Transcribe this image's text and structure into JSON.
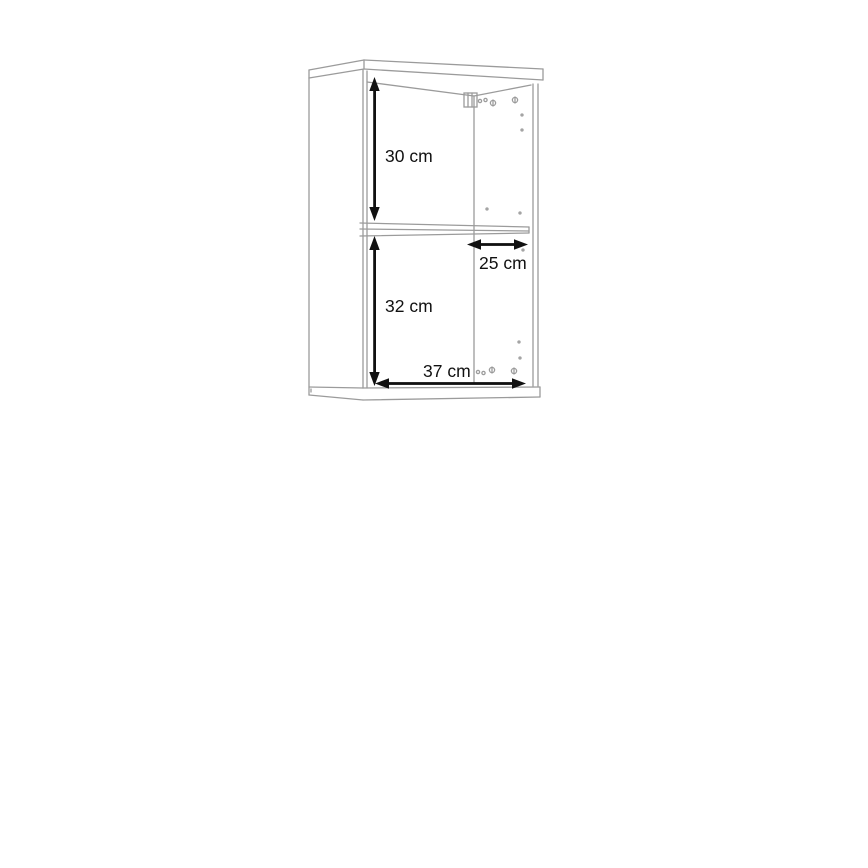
{
  "page": {
    "background": "#ffffff",
    "title": "Wall cabinet dimension drawing"
  },
  "diagram": {
    "type": "furniture-dimension-line-drawing",
    "subject": "wall-mounted cabinet with one middle shelf, shown in slight perspective",
    "line_color": "#9b9b9b",
    "ink_color": "#111111",
    "dimensions": [
      {
        "id": "upper-compartment-height",
        "label": "30 cm",
        "orientation": "vertical"
      },
      {
        "id": "shelf-depth",
        "label": "25 cm",
        "orientation": "horizontal"
      },
      {
        "id": "lower-compartment-height",
        "label": "32 cm",
        "orientation": "vertical"
      },
      {
        "id": "inner-width",
        "label": "37 cm",
        "orientation": "horizontal"
      }
    ],
    "features": [
      "wall-hanging bracket at top right of back panel",
      "rows of drill holes on inner right side panel",
      "adjustable shelf pin holes"
    ]
  }
}
